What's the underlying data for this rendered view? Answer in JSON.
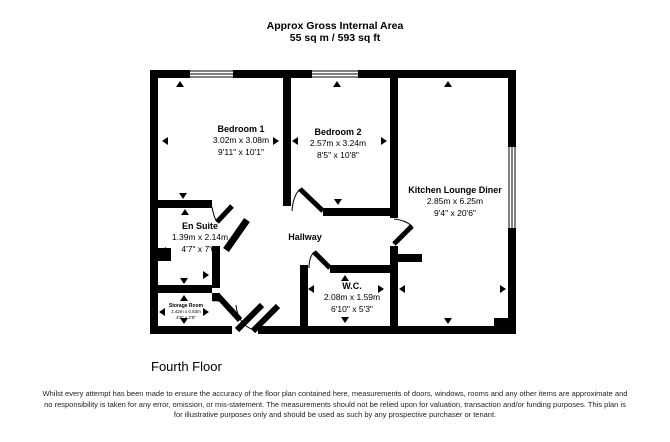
{
  "header": {
    "line1": "Approx Gross Internal Area",
    "line2": "55 sq m / 593 sq ft"
  },
  "rooms": {
    "bedroom1": {
      "name": "Bedroom 1",
      "metric": "3.02m x 3.08m",
      "imperial": "9'11\" x 10'1\""
    },
    "bedroom2": {
      "name": "Bedroom 2",
      "metric": "2.57m x 3.24m",
      "imperial": "8'5\" x 10'8\""
    },
    "kitchen": {
      "name": "Kitchen Lounge Diner",
      "metric": "2.85m x 6.25m",
      "imperial": "9'4\" x 20'6\""
    },
    "ensuite": {
      "name": "En Suite",
      "metric": "1.39m x 2.14m",
      "imperial": "4'7\" x 7'0\""
    },
    "hallway": {
      "name": "Hallway"
    },
    "wc": {
      "name": "W.C.",
      "metric": "2.08m x 1.59m",
      "imperial": "6'10\" x 5'3\""
    },
    "storage": {
      "name": "Storage Room",
      "metric": "1.42m x 0.83m",
      "imperial": "4'8\" x 2'9\""
    }
  },
  "floor_label": "Fourth Floor",
  "disclaimer": "Whilst every attempt has been made to ensure the accuracy of the floor plan contained here, measurements of doors, windows, rooms and any other items are approximate and no responsibility is taken for any error, omission, or mis-statement. The measurements should not be relied upon for valuation, transaction and/or funding purposes. This plan is for illustrative purposes only and should be used as such by any prospective purchaser or tenant.",
  "colors": {
    "wall": "#000000",
    "background": "#ffffff",
    "text": "#000000",
    "disclaimer_text": "#222222"
  }
}
